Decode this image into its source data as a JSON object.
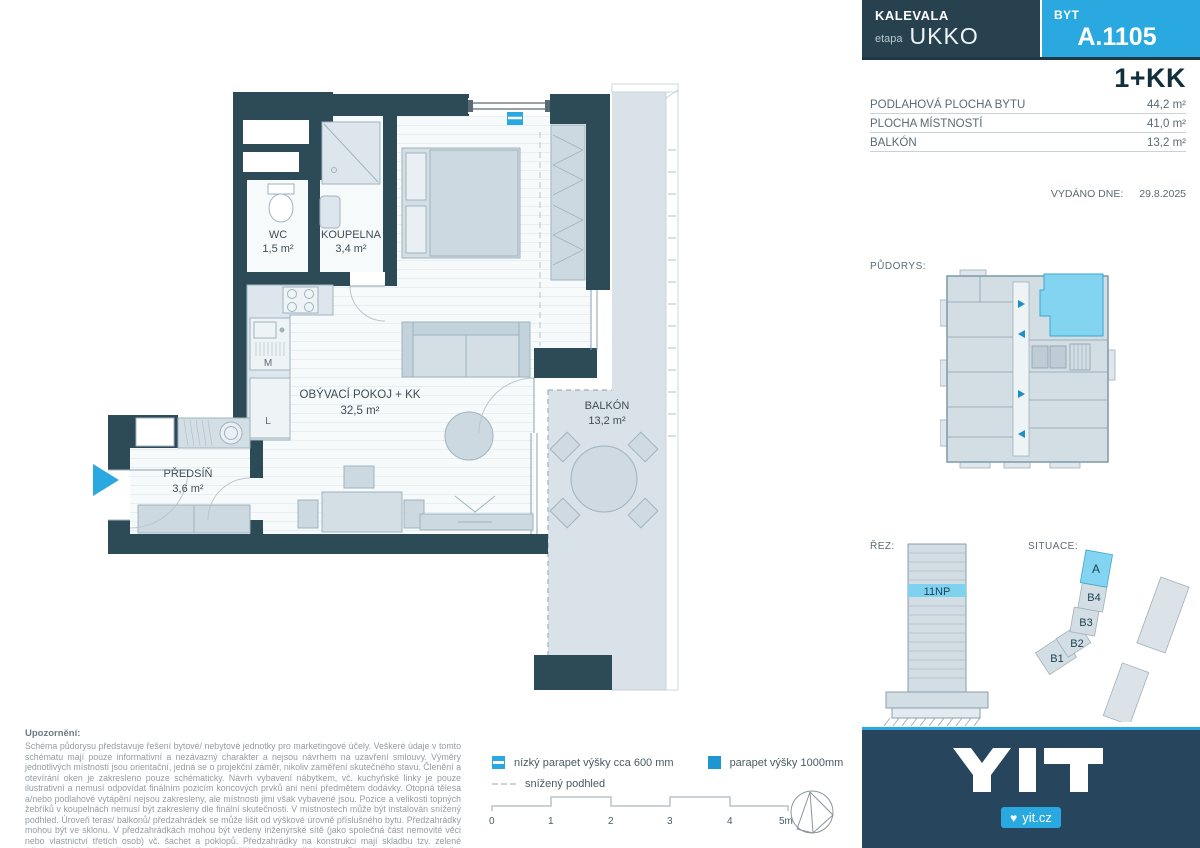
{
  "header": {
    "project": "KALEVALA",
    "etapa_label": "etapa",
    "etapa_value": "UKKO",
    "byt_label": "BYT",
    "unit_number": "A.1105"
  },
  "summary": {
    "layout": "1+KK",
    "rows": [
      {
        "label": "PODLAHOVÁ PLOCHA BYTU",
        "value": "44,2 m²"
      },
      {
        "label": "PLOCHA MÍSTNOSTÍ",
        "value": "41,0 m²"
      },
      {
        "label": "BALKÓN",
        "value": "13,2 m²"
      }
    ],
    "issued_label": "VYDÁNO DNE:",
    "issued_value": "29.8.2025"
  },
  "sections": {
    "pudorys_label": "PŮDORYS:",
    "rez_label": "ŘEZ:",
    "rez_floor": "11NP",
    "situace_label": "SITUACE:",
    "buildings": {
      "a": "A",
      "b4": "B4",
      "b3": "B3",
      "b2": "B2",
      "b1": "B1"
    }
  },
  "plan": {
    "rooms": {
      "wc": {
        "name": "WC",
        "area": "1,5 m²"
      },
      "koupelna": {
        "name": "KOUPELNA",
        "area": "3,4 m²"
      },
      "obyvaci": {
        "name": "OBÝVACÍ POKOJ + KK",
        "area": "32,5 m²"
      },
      "predsin": {
        "name": "PŘEDSÍŇ",
        "area": "3,6 m²"
      },
      "balkon": {
        "name": "BALKÓN",
        "area": "13,2 m²"
      }
    },
    "kitchen": {
      "m": "M",
      "l": "L"
    }
  },
  "legend": {
    "items": [
      {
        "label": "nízký parapet výšky cca 600 mm"
      },
      {
        "label": "parapet výšky 1000mm"
      },
      {
        "label": "snížený podhled"
      }
    ],
    "scale_ticks": [
      "0",
      "1",
      "2",
      "3",
      "4",
      "5m"
    ]
  },
  "disclaimer": {
    "title": "Upozornění:",
    "body": "Schéma půdorysu představuje řešení bytové/ nebytové jednotky pro marketingové účely. Veškeré údaje v tomto schématu mají pouze informativní a nezávazný charakter a nejsou návrhem na uzavření smlouvy. Výměry jednotlivých místností jsou orientační, jedná se o projekční záměr, nikoliv zaměření skutečného stavu. Členění a otevírání oken je zakresleno pouze schématicky. Návrh vybavení nábytkem, vč. kuchyňské linky je pouze ilustrativní a nemusí odpovídat finálním pozicím koncových prvků ani není předmětem dodávky. Otopná tělesa a/nebo podlahové vytápění nejsou zakresleny, ale místnosti jimi však vybavené jsou. Pozice a velikosti topných žebříků v koupelnách nemusí být zakresleny dle finální skutečnosti. V místnostech může být instalován snížený podhled. Úroveň teras/ balkonů/ předzahrádek se může lišit od výškové úrovně příslušného bytu. Předzahrádky mohou být ve sklonu. V předzahrádkách mohou být vedeny inženýrské sítě (jako společná část nemovité věci nebo vlastnictví třetích osob) vč. šachet a poklopů. Předzahrádky na konstrukci mají skladbu tzv. zelené střechy, dodatečné zatížení konstrukce a výsadba vyšší zeleně jsou limitovány. Pozice a rozměr zahradního domku/ boxu je pouze orientační."
  },
  "footer": {
    "logo": "YIT",
    "website": "yit.cz"
  },
  "colors": {
    "accent": "#29a9e0",
    "wall": "#2d4a57",
    "highlight": "#82d4f0",
    "footer_bg": "#27455c"
  }
}
